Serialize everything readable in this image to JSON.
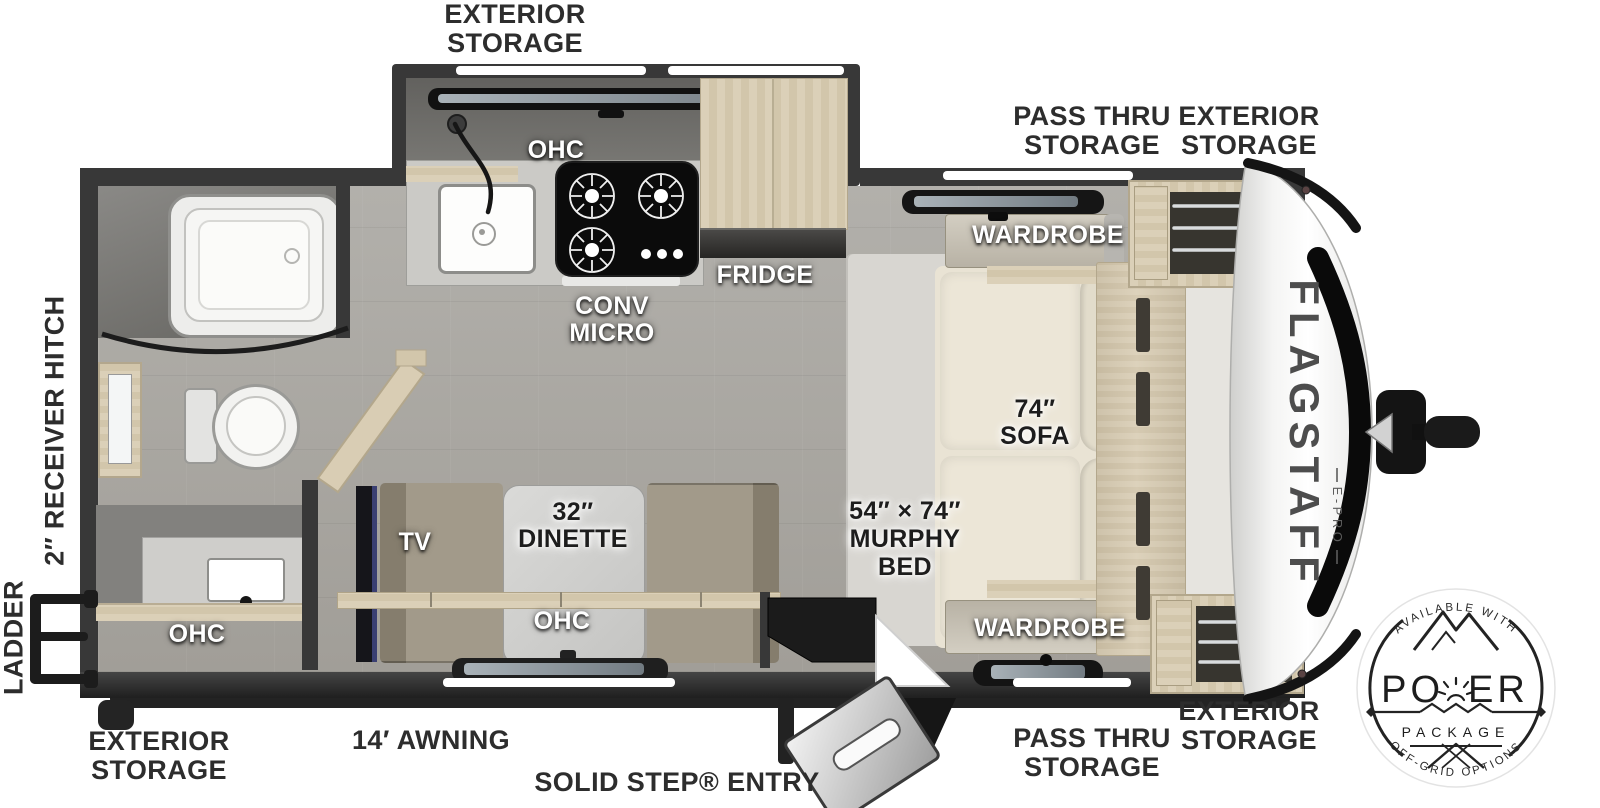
{
  "title": "Flagstaff E-Pro travel trailer floorplan",
  "brand": {
    "name": "FLAGSTAFF",
    "sub": "E-PRO"
  },
  "exterior_labels": {
    "top_exterior_storage": "EXTERIOR\nSTORAGE",
    "top_pass_thru_storage": "PASS THRU\nSTORAGE",
    "top_front_exterior_storage": "EXTERIOR\nSTORAGE",
    "receiver_hitch": "2″ RECEIVER HITCH",
    "ladder": "LADDER",
    "rear_exterior_storage": "EXTERIOR\nSTORAGE",
    "awning": "14′ AWNING",
    "entry": "SOLID STEP® ENTRY",
    "bottom_pass_thru_storage": "PASS THRU\nSTORAGE",
    "front_exterior_storage": "EXTERIOR\nSTORAGE"
  },
  "room_labels": {
    "kitchen_ohc": "OHC",
    "conv_micro": "CONV\nMICRO",
    "fridge": "FRIDGE",
    "wardrobe_top": "WARDROBE",
    "sofa": "74″\nSOFA",
    "murphy_bed": "54″ × 74″\nMURPHY\nBED",
    "wardrobe_bottom": "WARDROBE",
    "dinette": "32″\nDINETTE",
    "tv": "TV",
    "dinette_ohc": "OHC",
    "bath_ohc": "OHC"
  },
  "badge": {
    "top_text": "AVAILABLE WITH",
    "title": "POWER",
    "subtitle": "PACKAGE",
    "bottom_text": "OFF-GRID OPTIONS"
  },
  "colors": {
    "wall": "#383838",
    "floor": "#a8a5a0",
    "wood": "#d8ccb2",
    "counter": "#cbcac6",
    "sofa": "#e9e3d4",
    "bench": "#99917f",
    "tv_accent": "#3a3f72",
    "label_dark": "#2d2d2d",
    "label_light": "#ffffff"
  }
}
